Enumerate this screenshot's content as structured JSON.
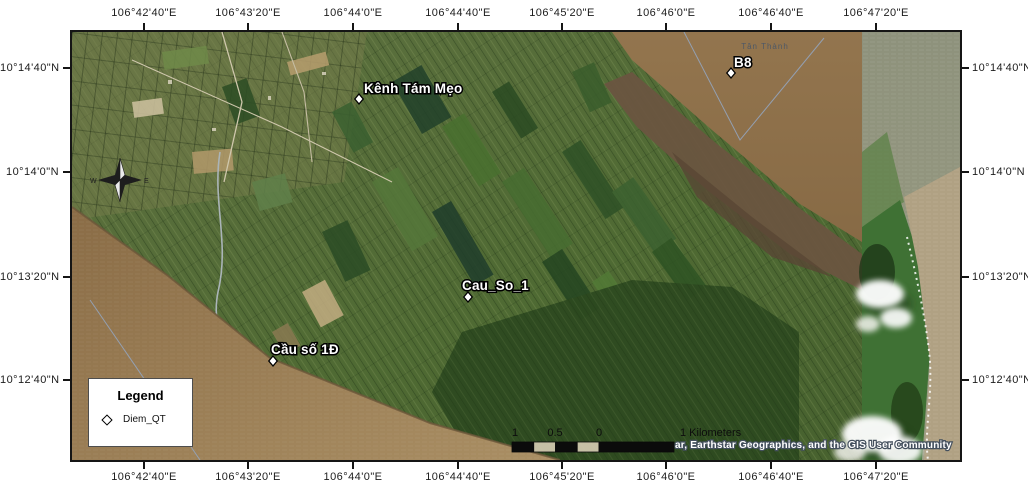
{
  "axes": {
    "top_labels": [
      "106°42'40\"E",
      "106°43'20\"E",
      "106°44'0\"E",
      "106°44'40\"E",
      "106°45'20\"E",
      "106°46'0\"E",
      "106°46'40\"E",
      "106°47'20\"E"
    ],
    "bottom_labels": [
      "106°42'40\"E",
      "106°43'20\"E",
      "106°44'0\"E",
      "106°44'40\"E",
      "106°45'20\"E",
      "106°46'0\"E",
      "106°46'40\"E",
      "106°47'20\"E"
    ],
    "left_labels": [
      "10°14'40\"N",
      "10°14'0\"N",
      "10°13'20\"N",
      "10°12'40\"N"
    ],
    "right_labels": [
      "10°14'40\"N",
      "10°14'0\"N",
      "10°13'20\"N",
      "10°12'40\"N"
    ]
  },
  "markers": [
    {
      "id": "kenh-tam-meo",
      "label": "Kênh Tám Mẹo",
      "x": 287,
      "y": 67,
      "label_x": 292,
      "label_y": 61
    },
    {
      "id": "b8",
      "label": "B8",
      "x": 659,
      "y": 41,
      "label_x": 662,
      "label_y": 35
    },
    {
      "id": "cau-so-1",
      "label": "Cau_So_1",
      "x": 396,
      "y": 265,
      "label_x": 390,
      "label_y": 258
    },
    {
      "id": "cau-so-1d",
      "label": "Cầu số 1Đ",
      "x": 201,
      "y": 329,
      "label_x": 199,
      "label_y": 322
    }
  ],
  "basemap_labels": [
    {
      "id": "tan-thanh",
      "label": "Tân Thành",
      "x": 693,
      "y": 17
    }
  ],
  "legend": {
    "title": "Legend",
    "items": [
      {
        "icon": "diamond-point-icon",
        "label": "Diem_QT"
      }
    ]
  },
  "scalebar": {
    "tick_labels": [
      "1",
      "0.5",
      "0"
    ],
    "tick_x": [
      443,
      483,
      527
    ],
    "unit_label": "1 Kilometers"
  },
  "attribution": "ar, Earthstar Geographics, and the GIS User Community",
  "compass": {
    "west": "W",
    "east": "E"
  },
  "colors": {
    "frame": "#151515",
    "land_green": "#4f6a33",
    "water_brown": "#97805c",
    "sea_gray_green": "#8e927c",
    "sea_tan": "#b0a183",
    "coastal_green": "#3f7134",
    "marker_fill": "#ffffff",
    "marker_stroke": "#000000",
    "label_halo": "#000000"
  }
}
